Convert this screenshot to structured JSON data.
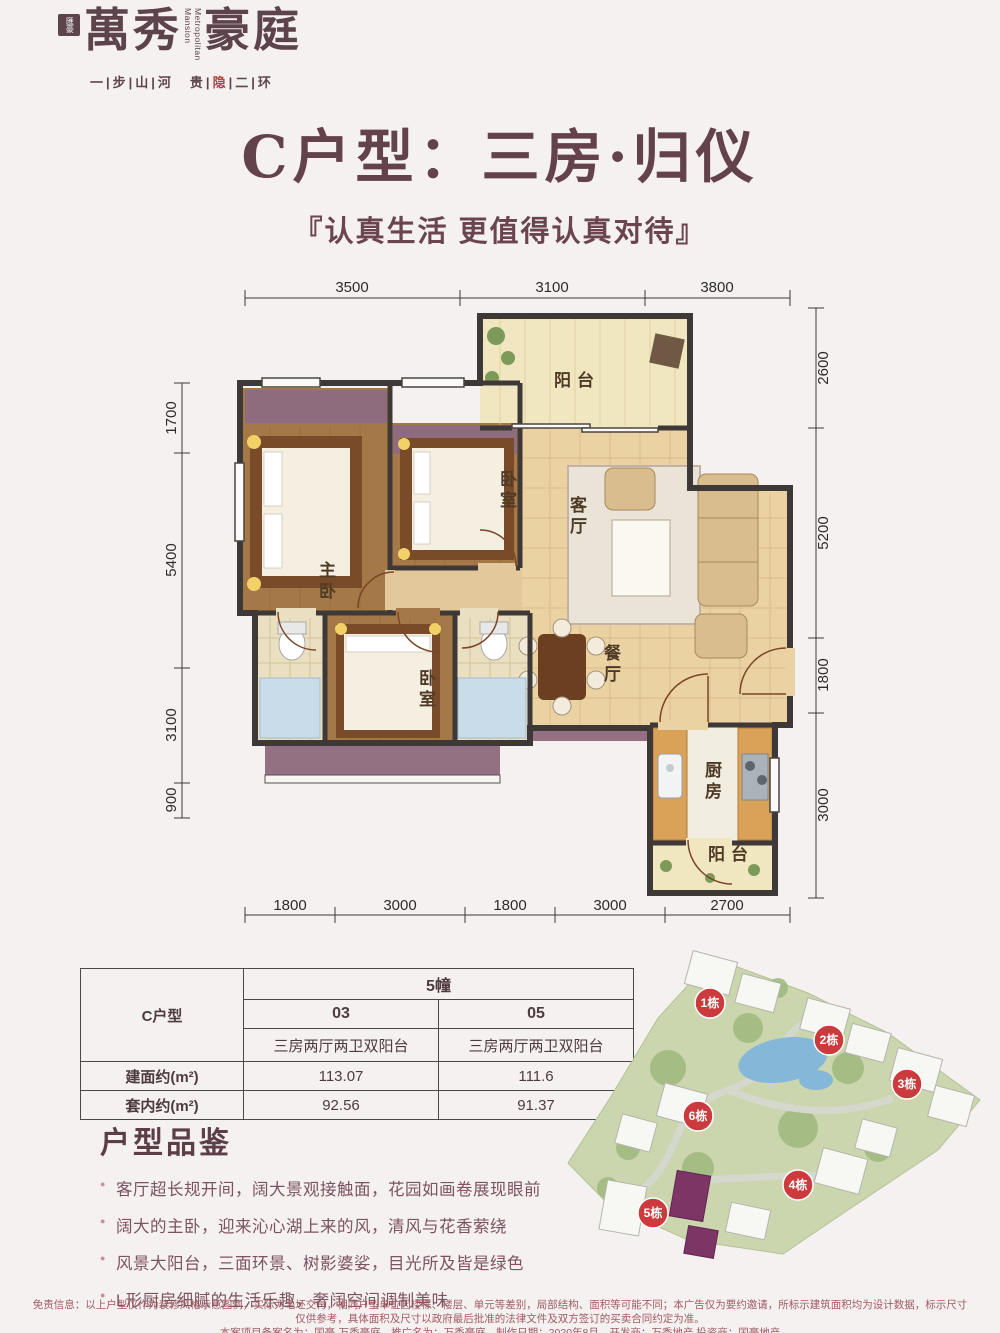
{
  "brand": {
    "seal": "匯豪",
    "name_a": "萬秀",
    "name_b": "豪庭",
    "en": "Metropolitan Mansion",
    "tagline_a": "一|步|山|河　贵|",
    "tagline_accent": "隐",
    "tagline_b": "|二|环"
  },
  "title": "C户型：三房·归仪",
  "subtitle": "『认真生活  更值得认真对待』",
  "plan": {
    "dims_top": [
      "3500",
      "3100",
      "3800"
    ],
    "dims_left": [
      "1700",
      "5400",
      "3100",
      "900"
    ],
    "dims_right": [
      "2600",
      "5200",
      "1800",
      "3000"
    ],
    "dims_bottom": [
      "1800",
      "3000",
      "1800",
      "3000",
      "2700"
    ],
    "rooms": {
      "balcony_top": "阳台",
      "bedroom2": "卧室",
      "living": "客厅",
      "master": "主卧",
      "bedroom3": "卧室",
      "dining": "餐厅",
      "kitchen": "厨房",
      "balcony_bottom": "阳台"
    }
  },
  "table": {
    "building": "5幢",
    "unit_type": "C户型",
    "col_03": "03",
    "col_05": "05",
    "layout_03": "三房两厅两卫双阳台",
    "layout_05": "三房两厅两卫双阳台",
    "row_gross": "建面约(m²)",
    "gross_03": "113.07",
    "gross_05": "111.6",
    "row_net": "套内约(m²)",
    "net_03": "92.56",
    "net_05": "91.37"
  },
  "features": {
    "heading": "户型品鉴",
    "items": [
      "客厅超长规开间，阔大景观接触面，花园如画卷展现眼前",
      "阔大的主卧，迎来沁心湖上来的风，清风与花香萦绕",
      "风景大阳台，三面环景、树影婆娑，目光所及皆是绿色",
      "L形厨房细腻的生活乐趣，奢阔空间调制美味"
    ]
  },
  "sitemap": {
    "badges": [
      "1栋",
      "2栋",
      "3栋",
      "6栋",
      "4栋",
      "5栋"
    ]
  },
  "disclaimer": {
    "line1": "免责信息：以上户型仅作为装修风格示意图例，实际为毛坯交付，相同户型单位因楼栋、楼层、单元等差别，局部结构、面积等可能不同；本广告仅为要约邀请，所标示建筑面积均为设计数据，标示尺寸仅供参考，具体面积及尺寸以政府最后批准的法律文件及双方签订的买卖合同约定为准。",
    "line2": "本案项目备案名为：国豪·万秀豪庭，推广名为：万秀豪庭，制作日期：2020年8月，开发商：万秀地产  投资商：国豪地产"
  },
  "colors": {
    "accent_maroon": "#63424b",
    "badge_red": "#cb3a3c",
    "wood_floor": "#a57947",
    "tile_floor": "#ebd2a2",
    "wardrobe_mauve": "#8e6b7d"
  }
}
